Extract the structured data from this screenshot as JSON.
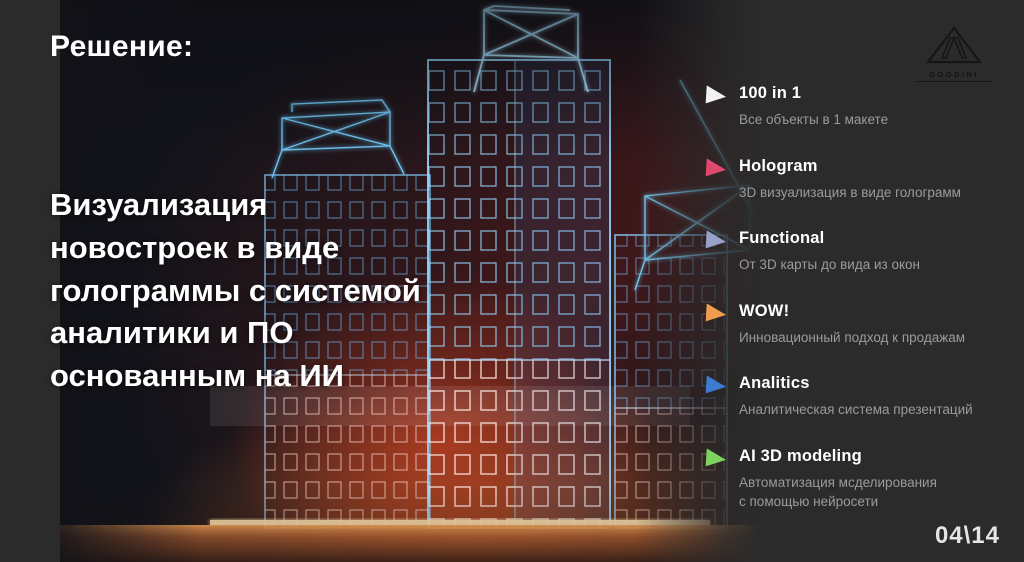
{
  "slide": {
    "title": "Решение:",
    "main_text": "Визуализация\nновостроек в виде\nголограммы с системой\nаналитики и ПО\nоснованным на ИИ",
    "page_number": "04\\14",
    "logo_text": "GOODINI"
  },
  "features": [
    {
      "title": "100 in 1",
      "description": "Все объекты в 1 макете",
      "marker_color": "#f2f2f2"
    },
    {
      "title": "Hologram",
      "description": "3D визуализация в виде голограмм",
      "marker_color": "#e0486e"
    },
    {
      "title": "Functional",
      "description": "От 3D карты до вида из окон",
      "marker_color": "#98a2c8"
    },
    {
      "title": "WOW!",
      "description": "Инновационный подход к продажам",
      "marker_color": "#f09d4d"
    },
    {
      "title": "Analitics",
      "description": "Аналитическая система презентаций",
      "marker_color": "#3c7bd0"
    },
    {
      "title": "AI 3D modeling",
      "description": "Автоматизация мсделирования\nс помощью нейросети",
      "marker_color": "#7cd45f"
    }
  ],
  "colors": {
    "background": "#2b2b2b",
    "glow_red": "#e14623",
    "glow_orange": "#ff7d2d",
    "wireframe_blue": "#6fc6f2",
    "text_primary": "#ffffff",
    "text_secondary": "#9b9b9b"
  }
}
